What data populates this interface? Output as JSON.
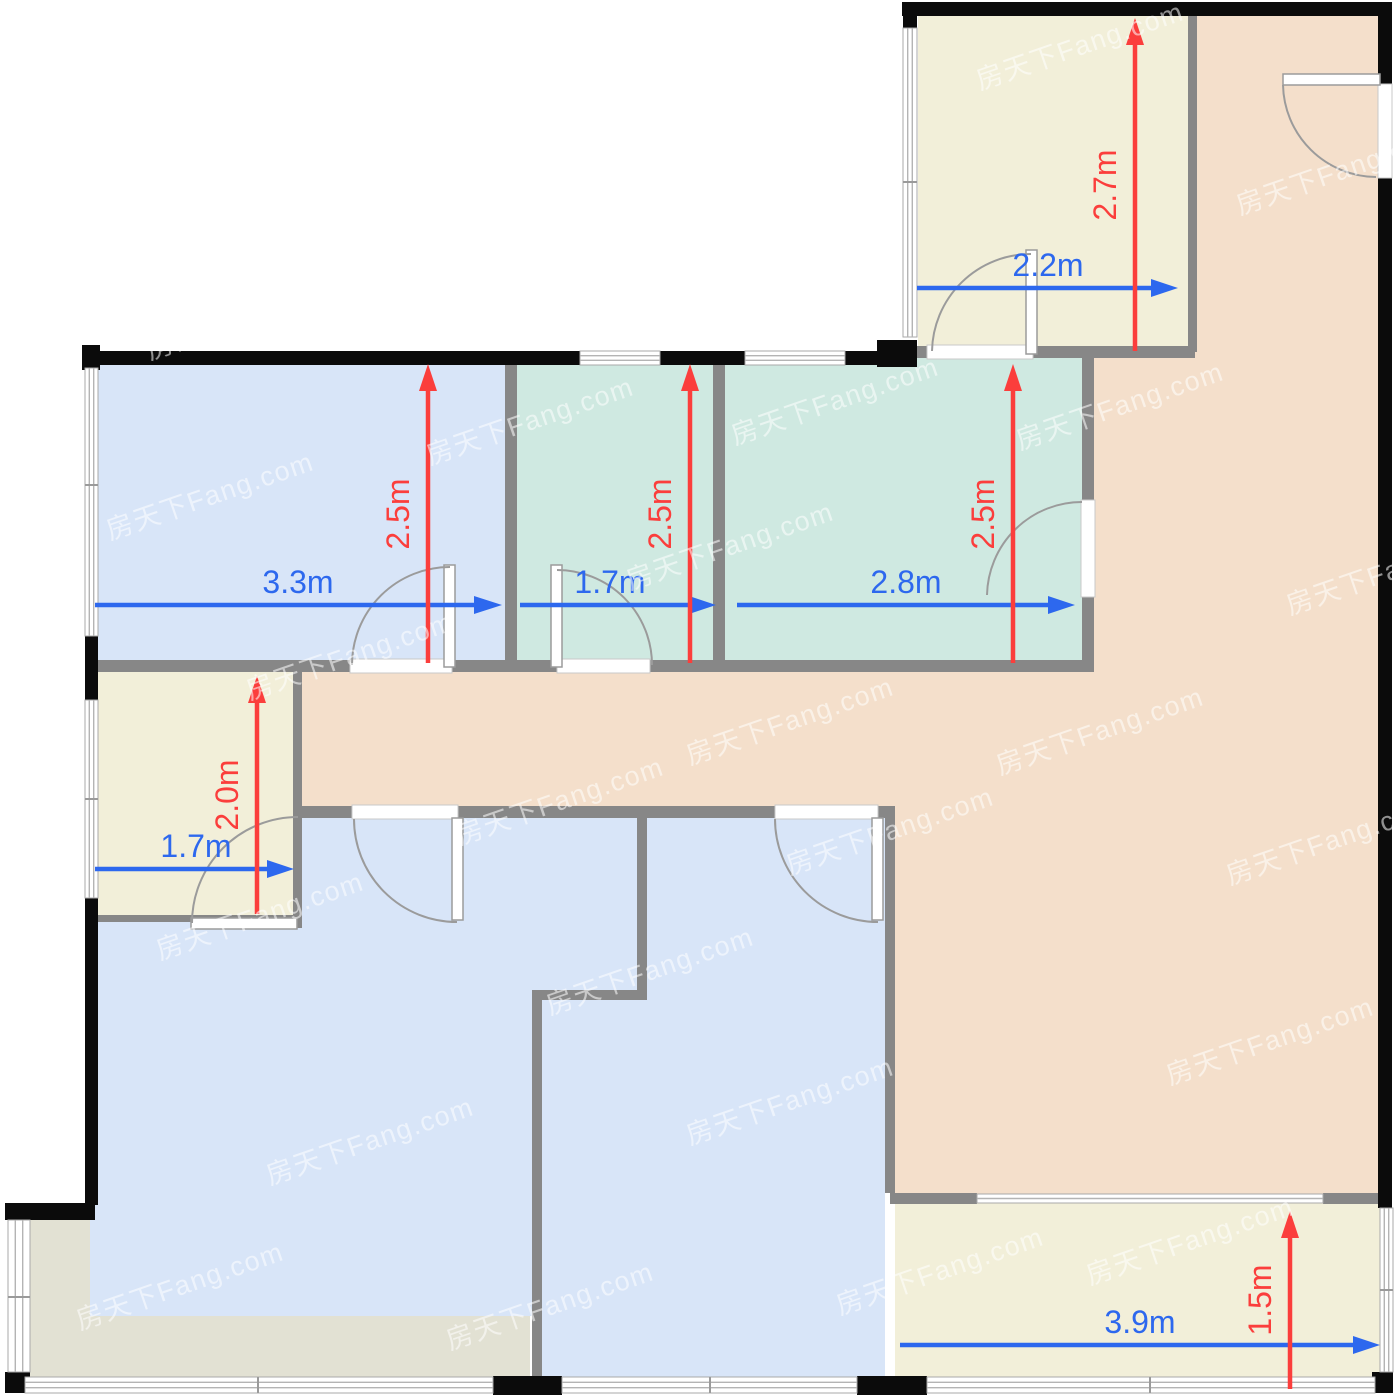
{
  "page": {
    "title": "Apartment floor plan with dimensions"
  },
  "watermark": "房天下Fang.com",
  "colors": {
    "dim_blue": "#2d68ee",
    "dim_red": "#fb3e3c",
    "wall_black": "#0b0b0b",
    "wall_gray": "#878787",
    "door_stroke": "#9b9b9b",
    "window_stroke": "#a9a9a9",
    "window_line": "#b4b4b4",
    "room_blue": "#d8e5f8",
    "room_teal": "#cfe9e1",
    "room_yellow": "#f2efd9",
    "room_peach": "#f4dfcb",
    "room_olive": "#e2e1d3",
    "watermark_color": "rgba(255,255,255,0.55)"
  },
  "rooms": [
    {
      "name": "bedroom-top-left",
      "width": "3.3m",
      "depth": "2.5m"
    },
    {
      "name": "small-room-top-middle",
      "width": "1.7m",
      "depth": "2.5m"
    },
    {
      "name": "bedroom-top-middle",
      "width": "2.8m",
      "depth": "2.5m"
    },
    {
      "name": "room-top-right",
      "width": "2.2m",
      "depth": "2.7m"
    },
    {
      "name": "small-room-left",
      "width": "1.7m",
      "depth": "2.0m"
    },
    {
      "name": "balcony-bottom-right",
      "width": "3.9m",
      "depth": "1.5m"
    }
  ]
}
